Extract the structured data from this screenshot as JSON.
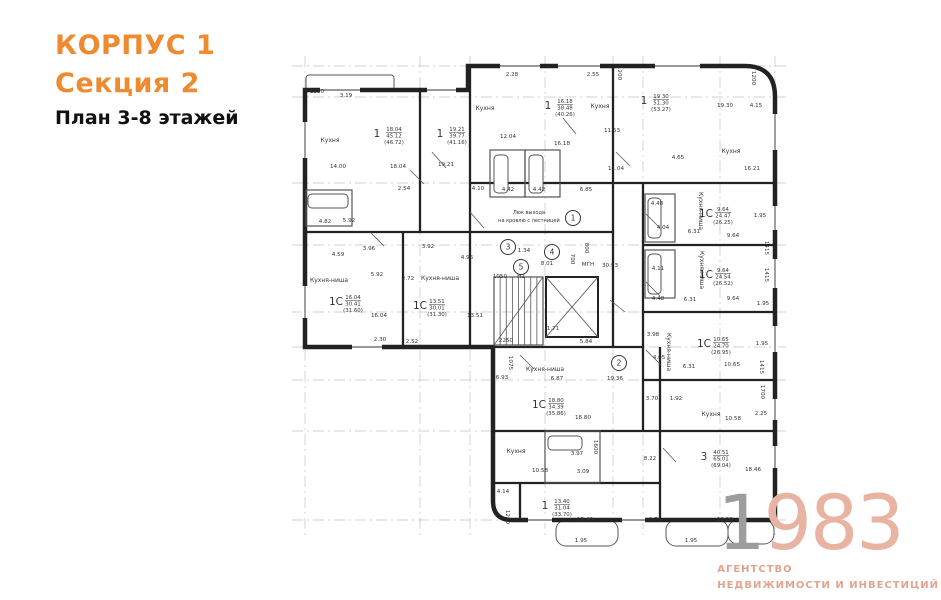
{
  "header": {
    "building": "КОРПУС 1",
    "section": "Секция 2",
    "plan_title": "План 3-8 этажей",
    "accent_color": "#ee8a2f",
    "plan_title_color": "#111111"
  },
  "logo": {
    "digit_one": "1",
    "digits_rest": "983",
    "line1": "АГЕНТСТВО",
    "line2": "НЕДВИЖИМОСТИ И ИНВЕСТИЦИЙ",
    "salmon": "#e2a48e",
    "digit_salmon": "#e8b4a1",
    "digit_gray": "#9d9d9d"
  },
  "plan": {
    "colors": {
      "wall": "#222222",
      "thin": "#555555",
      "axis": "#c2c2c2",
      "text": "#333333",
      "win": "#777777"
    },
    "outline": "M305,90 L468,90 L468,66 L745,66 Q775,66 775,97 L775,520 L512,520 Q493,520 493,501 L493,347 L305,347 Z",
    "axes": {
      "v": [
        305,
        420,
        470,
        545,
        613,
        643,
        720,
        775
      ],
      "h": [
        66,
        97,
        183,
        245,
        312,
        347,
        380,
        431,
        520
      ],
      "y0": 56,
      "y1": 538,
      "x0": 292,
      "x1": 788
    },
    "inner_walls": [
      [
        420,
        90,
        420,
        232
      ],
      [
        470,
        66,
        470,
        347
      ],
      [
        403,
        232,
        403,
        347
      ],
      [
        305,
        232,
        470,
        232
      ],
      [
        613,
        66,
        613,
        183
      ],
      [
        470,
        183,
        775,
        183
      ],
      [
        643,
        183,
        643,
        431
      ],
      [
        613,
        183,
        613,
        347
      ],
      [
        643,
        245,
        775,
        245
      ],
      [
        643,
        312,
        775,
        312
      ],
      [
        643,
        380,
        775,
        380
      ],
      [
        660,
        431,
        775,
        431
      ],
      [
        493,
        347,
        643,
        347
      ],
      [
        493,
        431,
        660,
        431
      ],
      [
        493,
        483,
        660,
        483
      ],
      [
        660,
        347,
        660,
        520
      ],
      [
        520,
        483,
        520,
        520
      ],
      [
        470,
        232,
        613,
        232
      ]
    ],
    "windows": [
      [
        500,
        66,
        540,
        66
      ],
      [
        558,
        66,
        600,
        66
      ],
      [
        655,
        66,
        700,
        66
      ],
      [
        320,
        90,
        360,
        90
      ],
      [
        427,
        90,
        456,
        90
      ],
      [
        775,
        114,
        775,
        150
      ],
      [
        775,
        206,
        775,
        230
      ],
      [
        775,
        259,
        775,
        288
      ],
      [
        775,
        326,
        775,
        352
      ],
      [
        775,
        399,
        775,
        420
      ],
      [
        775,
        446,
        775,
        468
      ],
      [
        528,
        520,
        552,
        520
      ],
      [
        622,
        520,
        645,
        520
      ],
      [
        305,
        122,
        305,
        158
      ],
      [
        305,
        286,
        305,
        318
      ],
      [
        352,
        347,
        382,
        347
      ]
    ],
    "doors": [
      [
        432,
        152,
        446,
        168
      ],
      [
        470,
        212,
        484,
        228
      ],
      [
        563,
        118,
        576,
        134
      ],
      [
        616,
        152,
        630,
        166
      ],
      [
        646,
        214,
        660,
        228
      ],
      [
        646,
        282,
        660,
        296
      ],
      [
        646,
        350,
        660,
        364
      ],
      [
        663,
        448,
        676,
        462
      ],
      [
        520,
        355,
        534,
        369
      ],
      [
        610,
        300,
        625,
        312
      ],
      [
        370,
        232,
        384,
        246
      ],
      [
        410,
        170,
        424,
        184
      ]
    ],
    "balconies": [
      [
        306,
        75,
        88,
        15,
        3
      ],
      [
        556,
        520,
        62,
        26,
        10
      ],
      [
        666,
        520,
        62,
        26,
        10
      ],
      [
        728,
        520,
        46,
        24,
        10
      ]
    ],
    "room_rects": [
      [
        490,
        150,
        35,
        47
      ],
      [
        525,
        150,
        35,
        47
      ],
      [
        645,
        194,
        30,
        48
      ],
      [
        645,
        250,
        30,
        48
      ],
      [
        545,
        431,
        55,
        52
      ],
      [
        306,
        190,
        46,
        36
      ]
    ],
    "tubs": [
      [
        494,
        155,
        14,
        38
      ],
      [
        529,
        155,
        14,
        38
      ],
      [
        648,
        198,
        13,
        40
      ],
      [
        648,
        254,
        13,
        40
      ],
      [
        548,
        436,
        34,
        14
      ],
      [
        308,
        194,
        40,
        14
      ]
    ],
    "stairs": {
      "x": 494,
      "y": 277,
      "w": 49,
      "h": 68,
      "steps": 8
    },
    "elevator": {
      "x": 546,
      "y": 277,
      "w": 52,
      "h": 60
    },
    "apartments": [
      {
        "type": "1",
        "lines": [
          "18.04",
          "45.12",
          "(46.72)"
        ],
        "x": 385,
        "y": 133
      },
      {
        "type": "1",
        "lines": [
          "19.21",
          "39.77",
          "(41.16)"
        ],
        "x": 448,
        "y": 133
      },
      {
        "type": "1",
        "lines": [
          "16.18",
          "38.48",
          "(40.26)"
        ],
        "x": 556,
        "y": 105
      },
      {
        "type": "1",
        "lines": [
          "19.30",
          "51.30",
          "(53.27)"
        ],
        "x": 652,
        "y": 100
      },
      {
        "type": "1С",
        "lines": [
          "9.64",
          "24.47",
          "(26.25)"
        ],
        "x": 714,
        "y": 213
      },
      {
        "type": "1С",
        "lines": [
          "9.64",
          "24.54",
          "(26.52)"
        ],
        "x": 714,
        "y": 274
      },
      {
        "type": "1С",
        "lines": [
          "10.65",
          "24.70",
          "(26.95)"
        ],
        "x": 712,
        "y": 343
      },
      {
        "type": "1С",
        "lines": [
          "16.04",
          "30.41",
          "(31.60)"
        ],
        "x": 344,
        "y": 301
      },
      {
        "type": "1С",
        "lines": [
          "13.51",
          "30.01",
          "(31.30)"
        ],
        "x": 428,
        "y": 305
      },
      {
        "type": "1С",
        "lines": [
          "18.80",
          "34.39",
          "(35.86)"
        ],
        "x": 547,
        "y": 404
      },
      {
        "type": "1",
        "lines": [
          "13.40",
          "31.04",
          "(33.70)"
        ],
        "x": 553,
        "y": 505
      },
      {
        "type": "3",
        "lines": [
          "40.51",
          "65.01",
          "(69.04)"
        ],
        "x": 712,
        "y": 456
      }
    ],
    "room_labels": [
      {
        "t": "Кухня",
        "x": 330,
        "y": 142
      },
      {
        "t": "Кухня",
        "x": 485,
        "y": 110
      },
      {
        "t": "Кухня",
        "x": 600,
        "y": 108
      },
      {
        "t": "Кухня",
        "x": 731,
        "y": 153
      },
      {
        "t": "Кухня",
        "x": 516,
        "y": 453
      },
      {
        "t": "Кухня",
        "x": 711,
        "y": 416
      },
      {
        "t": "Кухня-ниша",
        "x": 329,
        "y": 282
      },
      {
        "t": "Кухня-ниша",
        "x": 440,
        "y": 280
      },
      {
        "t": "Кухня-ниша",
        "x": 545,
        "y": 371
      },
      {
        "t": "Кухня-ниша",
        "x": 699,
        "y": 211,
        "r": 90
      },
      {
        "t": "Кухня-ниша",
        "x": 700,
        "y": 270,
        "r": 90
      },
      {
        "t": "Кухня-ниша",
        "x": 667,
        "y": 352,
        "r": 90
      }
    ],
    "dims": [
      {
        "t": "1250",
        "x": 317,
        "y": 93
      },
      {
        "t": "3.19",
        "x": 346,
        "y": 97
      },
      {
        "t": "14.00",
        "x": 338,
        "y": 168
      },
      {
        "t": "18.04",
        "x": 398,
        "y": 168
      },
      {
        "t": "2.54",
        "x": 404,
        "y": 190
      },
      {
        "t": "19.21",
        "x": 446,
        "y": 166
      },
      {
        "t": "2.28",
        "x": 512,
        "y": 76
      },
      {
        "t": "2.55",
        "x": 593,
        "y": 76
      },
      {
        "t": "1200",
        "x": 618,
        "y": 73,
        "r": 90
      },
      {
        "t": "12.04",
        "x": 508,
        "y": 138
      },
      {
        "t": "16.18",
        "x": 562,
        "y": 145
      },
      {
        "t": "11.53",
        "x": 612,
        "y": 132
      },
      {
        "t": "11.04",
        "x": 616,
        "y": 170
      },
      {
        "t": "6.85",
        "x": 586,
        "y": 191
      },
      {
        "t": "4.10",
        "x": 478,
        "y": 190
      },
      {
        "t": "4.42",
        "x": 508,
        "y": 191
      },
      {
        "t": "4.42",
        "x": 539,
        "y": 191
      },
      {
        "t": "19.30",
        "x": 725,
        "y": 107
      },
      {
        "t": "4.15",
        "x": 756,
        "y": 107
      },
      {
        "t": "1200",
        "x": 752,
        "y": 78,
        "r": 90
      },
      {
        "t": "4.65",
        "x": 678,
        "y": 159
      },
      {
        "t": "16.21",
        "x": 752,
        "y": 170
      },
      {
        "t": "4.48",
        "x": 657,
        "y": 205
      },
      {
        "t": "1.95",
        "x": 760,
        "y": 217
      },
      {
        "t": "4.04",
        "x": 663,
        "y": 229
      },
      {
        "t": "6.31",
        "x": 694,
        "y": 233
      },
      {
        "t": "9.64",
        "x": 733,
        "y": 237
      },
      {
        "t": "1415",
        "x": 765,
        "y": 248,
        "r": 90
      },
      {
        "t": "4.11",
        "x": 658,
        "y": 270
      },
      {
        "t": "9.64",
        "x": 733,
        "y": 300
      },
      {
        "t": "4.48",
        "x": 658,
        "y": 300
      },
      {
        "t": "6.31",
        "x": 690,
        "y": 301
      },
      {
        "t": "1.95",
        "x": 763,
        "y": 305
      },
      {
        "t": "1415",
        "x": 765,
        "y": 275,
        "r": 90
      },
      {
        "t": "3.98",
        "x": 653,
        "y": 336
      },
      {
        "t": "1.95",
        "x": 762,
        "y": 345
      },
      {
        "t": "10.65",
        "x": 732,
        "y": 366
      },
      {
        "t": "4.05",
        "x": 659,
        "y": 359
      },
      {
        "t": "6.31",
        "x": 689,
        "y": 368
      },
      {
        "t": "1415",
        "x": 760,
        "y": 367,
        "r": 90
      },
      {
        "t": "3.70",
        "x": 652,
        "y": 400
      },
      {
        "t": "1.92",
        "x": 676,
        "y": 400
      },
      {
        "t": "1700",
        "x": 761,
        "y": 392,
        "r": 90
      },
      {
        "t": "2.25",
        "x": 761,
        "y": 415
      },
      {
        "t": "10.58",
        "x": 733,
        "y": 420
      },
      {
        "t": "18.46",
        "x": 753,
        "y": 471
      },
      {
        "t": "8.22",
        "x": 650,
        "y": 460
      },
      {
        "t": "5.92",
        "x": 349,
        "y": 222
      },
      {
        "t": "4.82",
        "x": 325,
        "y": 223
      },
      {
        "t": "3.96",
        "x": 369,
        "y": 250
      },
      {
        "t": "3.92",
        "x": 428,
        "y": 248
      },
      {
        "t": "4.59",
        "x": 338,
        "y": 256
      },
      {
        "t": "4.96",
        "x": 467,
        "y": 259
      },
      {
        "t": "5.92",
        "x": 377,
        "y": 276
      },
      {
        "t": "2.72",
        "x": 408,
        "y": 280
      },
      {
        "t": "16.04",
        "x": 379,
        "y": 317
      },
      {
        "t": "13.51",
        "x": 475,
        "y": 317
      },
      {
        "t": "2.30",
        "x": 380,
        "y": 341
      },
      {
        "t": "2.52",
        "x": 412,
        "y": 343
      },
      {
        "t": "8.01",
        "x": 547,
        "y": 265
      },
      {
        "t": "800",
        "x": 585,
        "y": 248,
        "r": 90
      },
      {
        "t": "700",
        "x": 571,
        "y": 259,
        "r": 90
      },
      {
        "t": "МГН",
        "x": 588,
        "y": 266
      },
      {
        "t": "30.93",
        "x": 610,
        "y": 267
      },
      {
        "t": "1050",
        "x": 500,
        "y": 278
      },
      {
        "t": "Н2",
        "x": 521,
        "y": 278
      },
      {
        "t": "1.34",
        "x": 524,
        "y": 252
      },
      {
        "t": "2250",
        "x": 506,
        "y": 342
      },
      {
        "t": "1.71",
        "x": 553,
        "y": 330
      },
      {
        "t": "5.84",
        "x": 586,
        "y": 343
      },
      {
        "t": "1075",
        "x": 509,
        "y": 363,
        "r": 90
      },
      {
        "t": "6.93",
        "x": 502,
        "y": 379
      },
      {
        "t": "6.87",
        "x": 557,
        "y": 380
      },
      {
        "t": "19.36",
        "x": 615,
        "y": 380
      },
      {
        "t": "18.80",
        "x": 583,
        "y": 419
      },
      {
        "t": "3.97",
        "x": 577,
        "y": 455
      },
      {
        "t": "1600",
        "x": 594,
        "y": 447,
        "r": 90
      },
      {
        "t": "10.58",
        "x": 540,
        "y": 472
      },
      {
        "t": "3.09",
        "x": 583,
        "y": 473
      },
      {
        "t": "4.14",
        "x": 503,
        "y": 493
      },
      {
        "t": "1200",
        "x": 506,
        "y": 517,
        "r": 90
      },
      {
        "t": "15.40",
        "x": 585,
        "y": 521
      },
      {
        "t": "9.76",
        "x": 655,
        "y": 521
      },
      {
        "t": "12.29",
        "x": 725,
        "y": 521
      },
      {
        "t": "1.95",
        "x": 581,
        "y": 542
      },
      {
        "t": "1.95",
        "x": 691,
        "y": 542
      }
    ],
    "markers": [
      {
        "n": "1",
        "x": 573,
        "y": 218
      },
      {
        "n": "2",
        "x": 619,
        "y": 363
      },
      {
        "n": "3",
        "x": 508,
        "y": 247
      },
      {
        "n": "4",
        "x": 552,
        "y": 252
      },
      {
        "n": "5",
        "x": 521,
        "y": 267
      }
    ],
    "notes": [
      {
        "t": "Люк выхода",
        "x": 529,
        "y": 214
      },
      {
        "t": "на кровлю с лестницей",
        "x": 529,
        "y": 222
      }
    ]
  }
}
